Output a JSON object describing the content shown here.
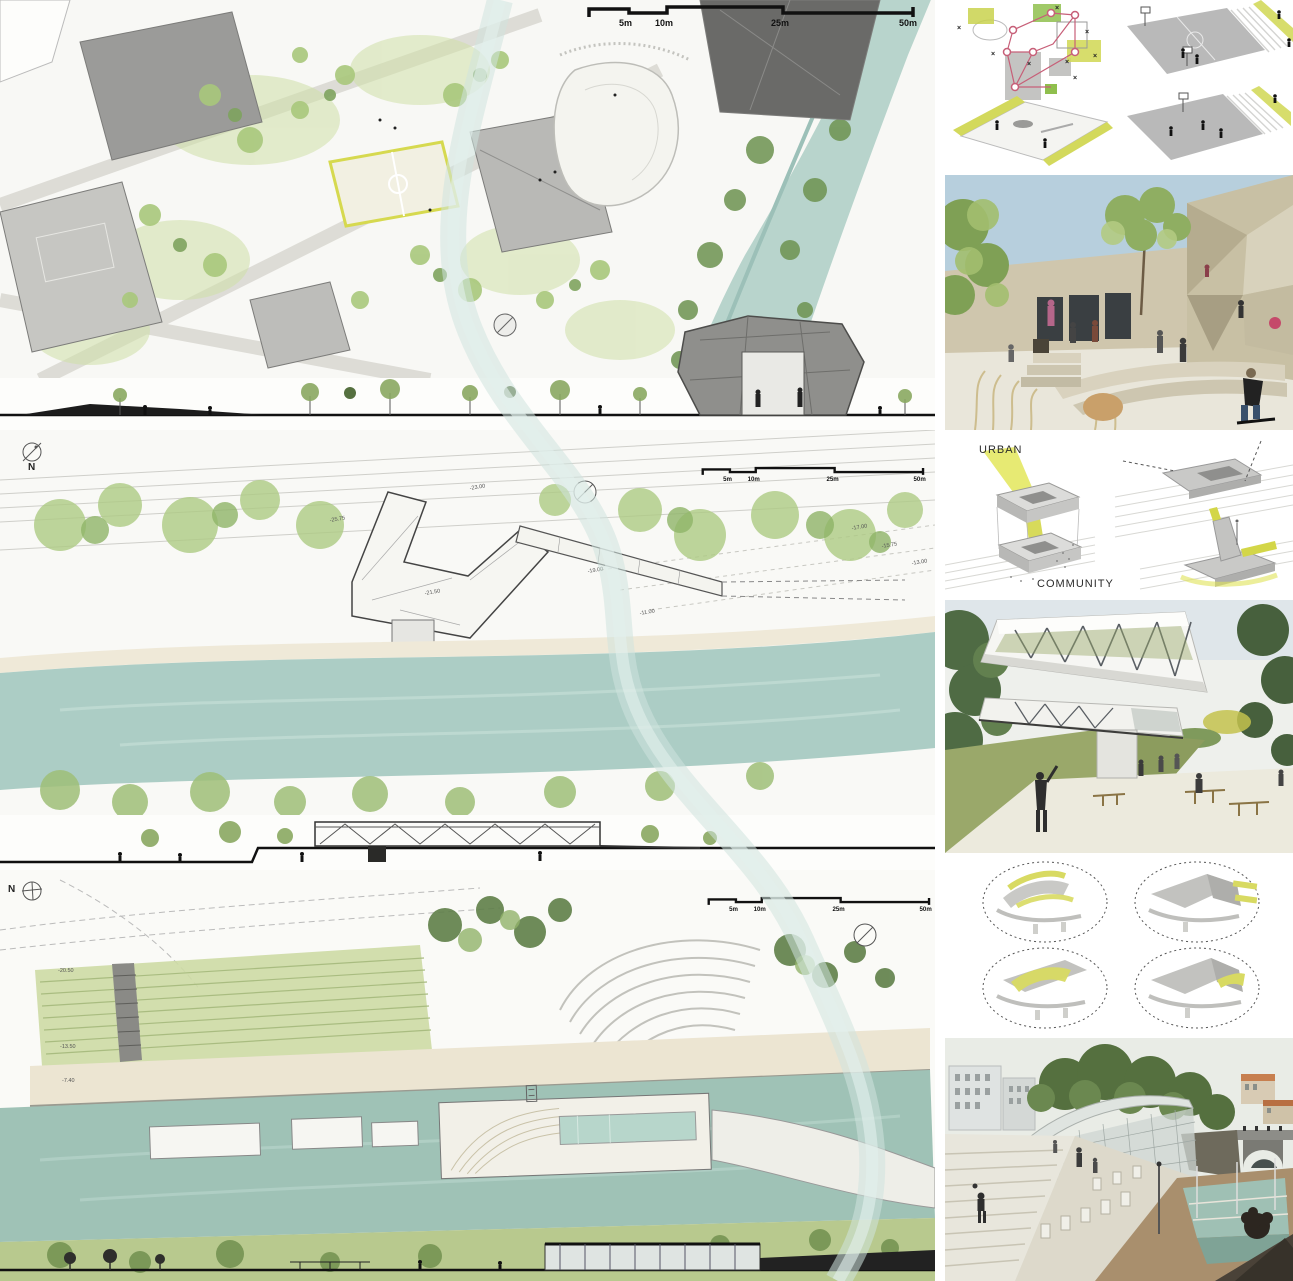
{
  "scale_bar": {
    "labels": [
      "5m",
      "10m",
      "25m",
      "50m"
    ]
  },
  "plans": [
    {
      "id": "masterplan-site-plan"
    },
    {
      "id": "building-level-plan",
      "north_label": "N",
      "spot_elevations": [
        "-25.75",
        "-23.00",
        "-21.50",
        "-19.00",
        "-17.00",
        "-15.75",
        "-13.00",
        "-11.00"
      ]
    },
    {
      "id": "riverfront-plan",
      "north_label": "N",
      "spot_elevations": [
        "-20.50",
        "-13.50",
        "-7.40"
      ]
    }
  ],
  "diagrams": {
    "flow": {
      "urban_label": "URBAN",
      "community_label": "COMMUNITY"
    }
  },
  "palette": {
    "paper": "#f8f8f4",
    "river": "#a9ccc2",
    "foliage": "#a3c177",
    "accent": "#d6d95e",
    "red": "#c75f78",
    "ink": "#1a1a1a",
    "sky": "#b5cfdf",
    "tan": "#cfc7ae"
  }
}
